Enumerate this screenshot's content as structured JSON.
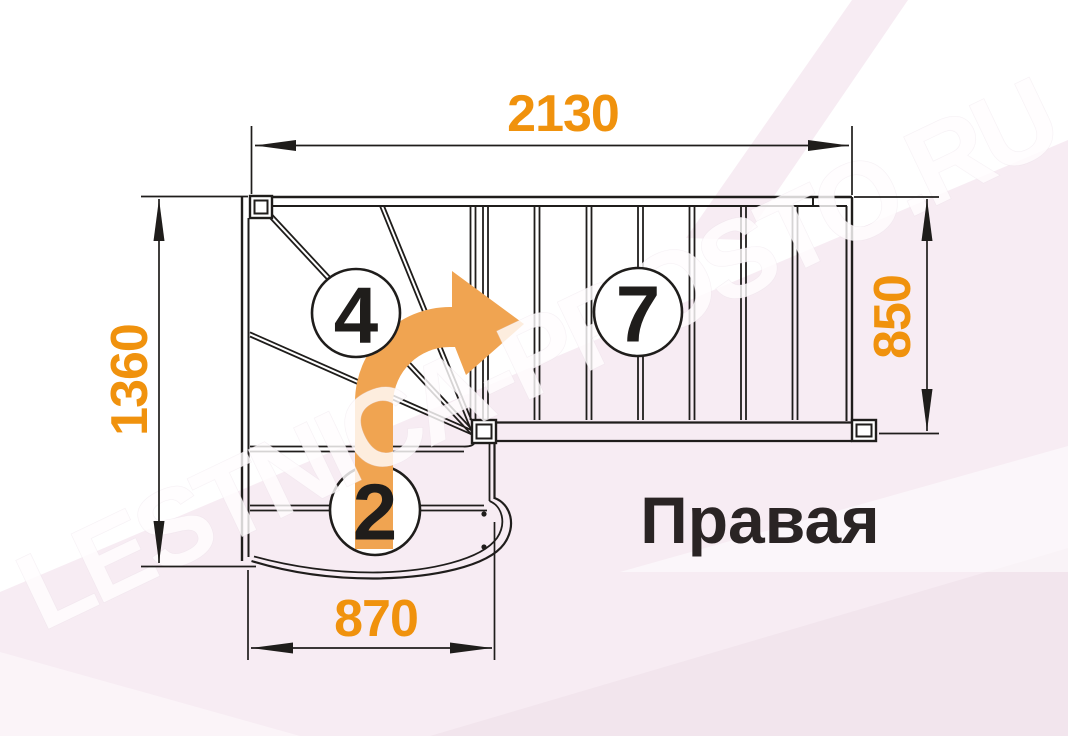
{
  "diagram": {
    "orientation_label": "Правая",
    "watermark": "LESTNICA-PROSTO.RU",
    "dimensions_mm": {
      "overall_length_top": "2130",
      "overall_depth_left": "1360",
      "flight_width_right": "850",
      "bottom_flight_width": "870"
    },
    "step_counts": {
      "winder_steps": "4",
      "upper_flight_steps": "7",
      "bottom_steps": "2"
    },
    "colors": {
      "dimension_text": "#F0920D",
      "direction_arrow": "#F0A451",
      "drawing_lines": "#1F1D1B",
      "background_tint": "#F7ECF3",
      "orientation_text": "#2A2424"
    }
  }
}
